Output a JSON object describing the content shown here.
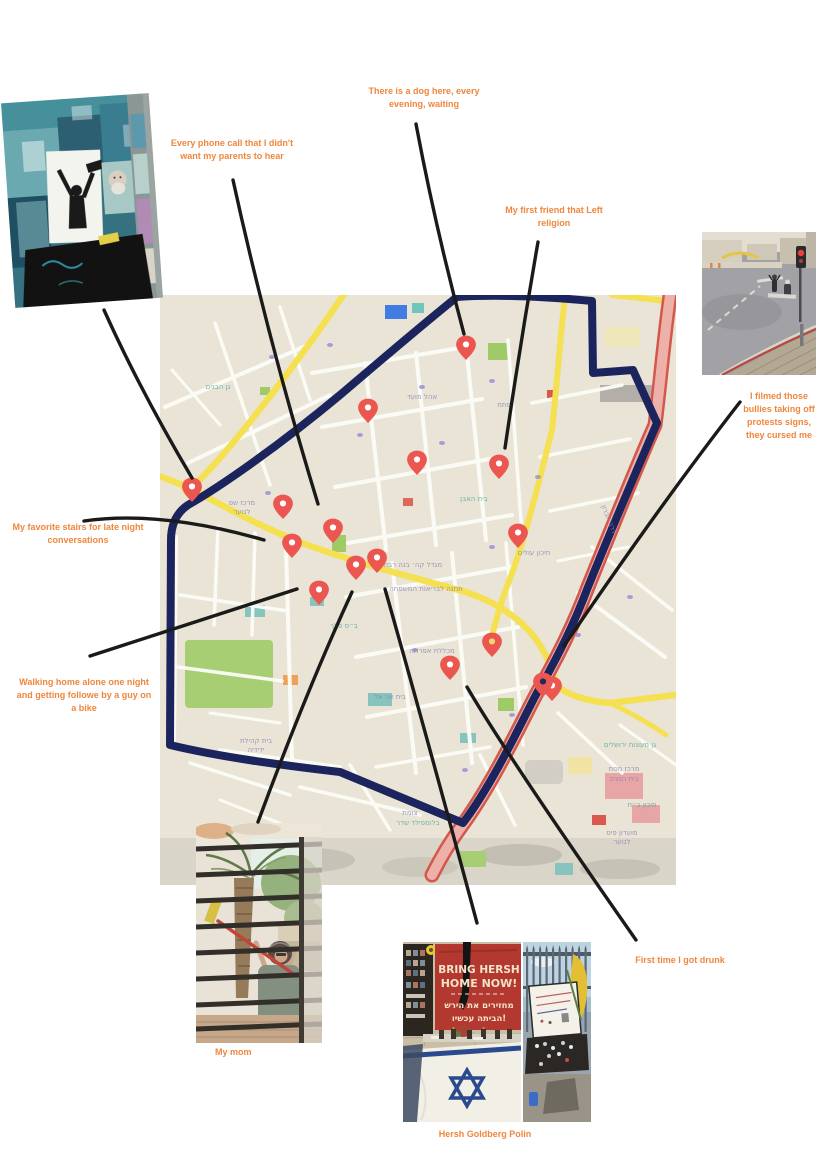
{
  "canvas": {
    "width": 824,
    "height": 1165,
    "background": "#ffffff"
  },
  "labels": {
    "color": "#ef863d",
    "dog": "There is a dog here, every evening, waiting",
    "phone": "Every phone call that I didn't want my parents to hear",
    "friend": "My first friend that Left religion",
    "bullies": "I filmed those bullies taking off protests signs, they cursed me",
    "stairs": "My favorite stairs for late night conversations",
    "walking": "Walking home alone one night and getting followe by a guy on a bike",
    "drunk": "First time I got drunk",
    "mom_caption": "My mom",
    "hersh_caption": "Hersh Goldberg Polin"
  },
  "map": {
    "background": "#e9e4d4",
    "route_color": "#1b2460",
    "road_yellow": "#f6e04b",
    "road_pink": "#f0b0a8",
    "road_red": "#d9564a",
    "pin_color": "#f2544f",
    "label_purple": "#8b81b8",
    "label_teal": "#4fa79c",
    "pins": [
      {
        "x": 306,
        "y": 50
      },
      {
        "x": 208,
        "y": 113
      },
      {
        "x": 257,
        "y": 165
      },
      {
        "x": 339,
        "y": 169
      },
      {
        "x": 32,
        "y": 192
      },
      {
        "x": 123,
        "y": 209
      },
      {
        "x": 173,
        "y": 233
      },
      {
        "x": 132,
        "y": 248
      },
      {
        "x": 358,
        "y": 238
      },
      {
        "x": 217,
        "y": 263
      },
      {
        "x": 196,
        "y": 270
      },
      {
        "x": 159,
        "y": 295
      },
      {
        "x": 332,
        "y": 347,
        "dot": "#f0d969"
      },
      {
        "x": 290,
        "y": 370
      },
      {
        "x": 392,
        "y": 391
      },
      {
        "x": 383,
        "y": 387,
        "dot": "#1d2b5e"
      }
    ],
    "street_labels": [
      {
        "t": "גן הבנים",
        "x": 58,
        "y": 94,
        "c": "teal"
      },
      {
        "t": "אהל מועד",
        "x": 262,
        "y": 104,
        "c": "purple"
      },
      {
        "t": "פתח",
        "x": 344,
        "y": 112,
        "c": "purple"
      },
      {
        "t": "מרכז שפ",
        "x": 82,
        "y": 210,
        "c": "purple"
      },
      {
        "t": "לנוער",
        "x": 82,
        "y": 219,
        "c": "purple"
      },
      {
        "t": "בית האבן",
        "x": 314,
        "y": 206,
        "c": "teal"
      },
      {
        "t": "תיכון עולים",
        "x": 374,
        "y": 260,
        "c": "purple"
      },
      {
        "t": "מגדל קה׳ בנה רבתי",
        "x": 252,
        "y": 272,
        "c": "purple"
      },
      {
        "t": "תחנה לבריאות המשפחה",
        "x": 266,
        "y": 296,
        "c": "purple"
      },
      {
        "t": "ב״ס פלך",
        "x": 184,
        "y": 333,
        "c": "teal"
      },
      {
        "t": "מכללת אפרתה",
        "x": 272,
        "y": 358,
        "c": "purple"
      },
      {
        "t": "בית אר אל",
        "x": 230,
        "y": 404,
        "c": "purple"
      },
      {
        "t": "בית קהילת",
        "x": 96,
        "y": 448,
        "c": "purple"
      },
      {
        "t": "ידידיה",
        "x": 96,
        "y": 457,
        "c": "purple"
      },
      {
        "t": "צומת",
        "x": 250,
        "y": 520,
        "c": "purple"
      },
      {
        "t": "בלומפילד שדר",
        "x": 258,
        "y": 530,
        "c": "teal"
      },
      {
        "t": "גן מעונות ירושלים",
        "x": 470,
        "y": 452,
        "c": "teal"
      },
      {
        "t": "מרכז מסח",
        "x": 464,
        "y": 476,
        "c": "purple"
      },
      {
        "t": "בית הנציב",
        "x": 464,
        "y": 486,
        "c": "purple"
      },
      {
        "t": "תיכון ב״ח",
        "x": 482,
        "y": 512,
        "c": "teal"
      },
      {
        "t": "מועדון פיס",
        "x": 462,
        "y": 540,
        "c": "purple"
      },
      {
        "t": "לנוער",
        "x": 462,
        "y": 549,
        "c": "purple"
      },
      {
        "t": "דרך חברון",
        "x": 447,
        "y": 225,
        "c": "purple",
        "r": 68
      }
    ]
  },
  "photos": {
    "banner": {
      "line1": "BRING HERSH",
      "line2": "HOME NOW!",
      "hebrew1": "מחזירים את הירש",
      "hebrew2": "הביתה עכשיו!"
    }
  }
}
